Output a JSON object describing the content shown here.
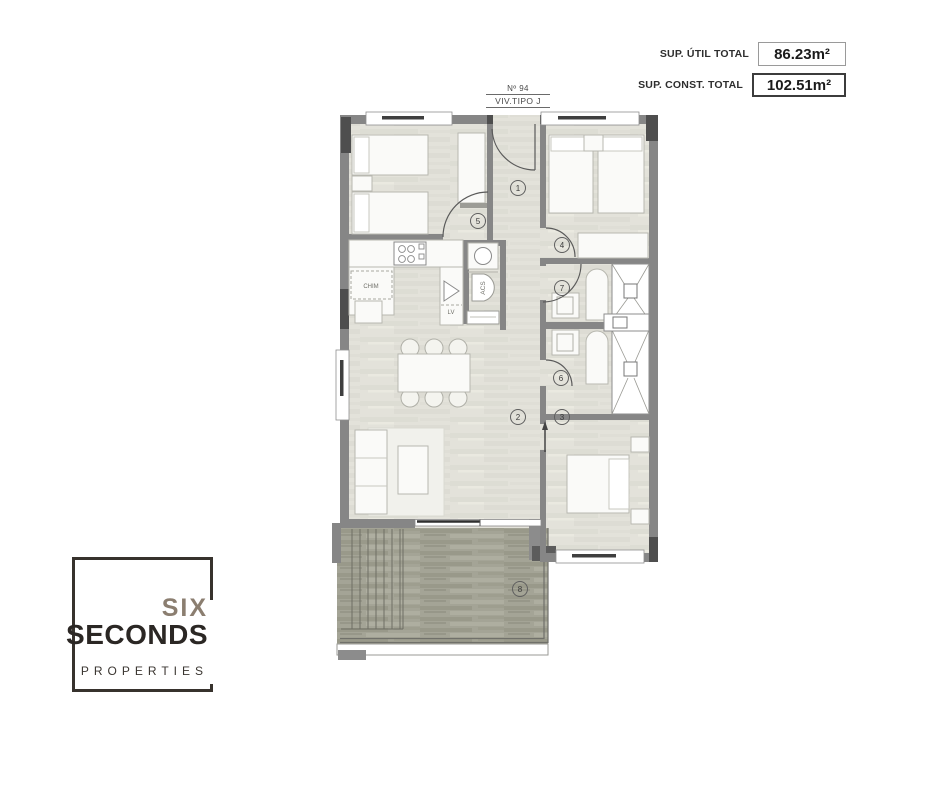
{
  "area_summary": {
    "rows": [
      {
        "label": "SUP. ÚTIL TOTAL",
        "value": "86.23m²"
      },
      {
        "label": "SUP. CONST. TOTAL",
        "value": "102.51m²"
      }
    ]
  },
  "plan_title": {
    "number": "Nº 94",
    "type": "VIV.TIPO J"
  },
  "plan": {
    "markers": [
      "1",
      "2",
      "3",
      "4",
      "5",
      "6",
      "7",
      "8"
    ],
    "labels": {
      "chimney": "CHIM",
      "dishwasher": "LV",
      "water_heater": "ACS"
    }
  },
  "logo": {
    "word1": "SIX",
    "word2": "SECONDS",
    "word3": "PROPERTIES"
  },
  "colors": {
    "wall": "#868686",
    "wall_dark": "#4e4e4e",
    "floor": "#e3e2da",
    "deck": "#a4a496",
    "logo_accent": "#8b7e70",
    "logo_dark": "#2b2724"
  }
}
